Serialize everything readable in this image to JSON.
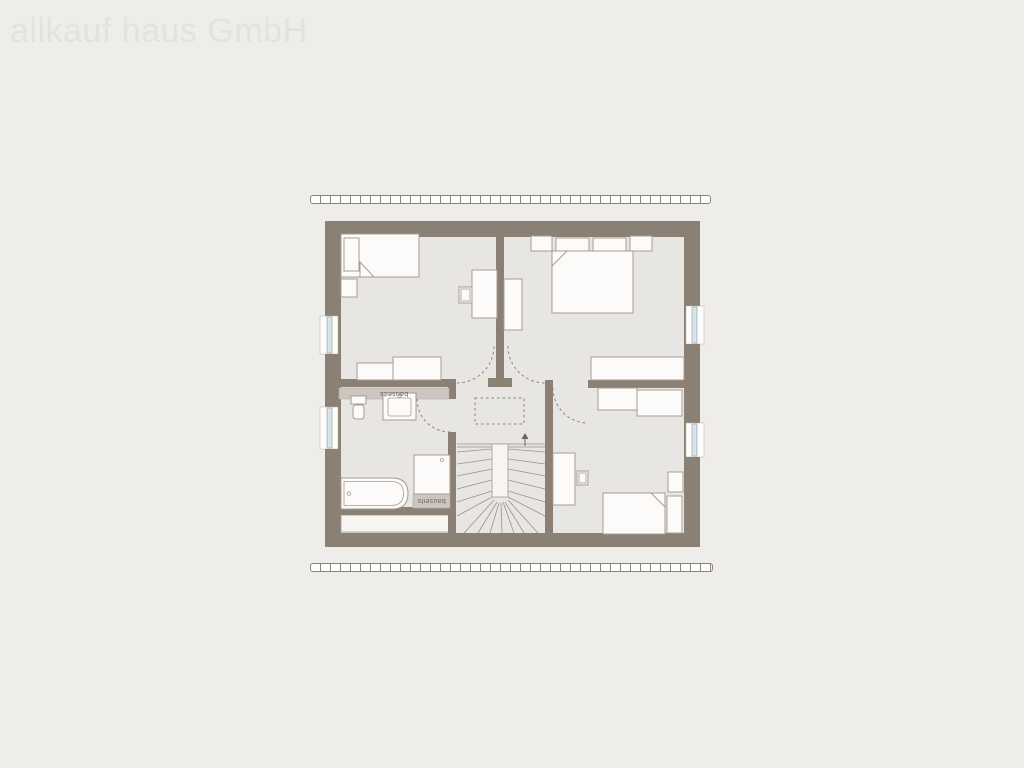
{
  "watermark": "allkauf haus GmbH",
  "labels": {
    "knee_wall_note": "bauseits",
    "shower_note": "bauseits"
  },
  "colors": {
    "background": "#efedea",
    "watermark_text": "#e4e2de",
    "wall": "#8b8074",
    "floor": "#e8e6e3",
    "furniture_fill": "#fcfbfa",
    "furniture_stroke": "#a59c92",
    "outline": "#8a8378",
    "glazing": "#d6e6ef",
    "note_band_fill": "#cbc6bf",
    "note_band_text": "#6e665c",
    "niche_fill": "#f6f5f2"
  },
  "plan": {
    "type": "attic floor plan",
    "window_count": 4,
    "door_count": 4,
    "rooms": [
      {
        "id": "bedroom-top-left",
        "furniture": [
          "single bed",
          "pillow",
          "nightstand",
          "desk",
          "chair",
          "sideboard",
          "sideboard"
        ]
      },
      {
        "id": "bedroom-top-right",
        "furniture": [
          "double bed",
          "pillow",
          "pillow",
          "nightstand",
          "nightstand",
          "wardrobe",
          "sideboard"
        ]
      },
      {
        "id": "bathroom",
        "furniture": [
          "bathtub",
          "shower",
          "washbasin",
          "wc"
        ]
      },
      {
        "id": "bedroom-bottom-right",
        "furniture": [
          "single bed",
          "pillow",
          "nightstand",
          "desk",
          "chair",
          "cabinet",
          "cabinet"
        ]
      },
      {
        "id": "hallway",
        "features": [
          "winder staircase",
          "stair direction arrow",
          "dashed roof opening"
        ]
      }
    ]
  }
}
